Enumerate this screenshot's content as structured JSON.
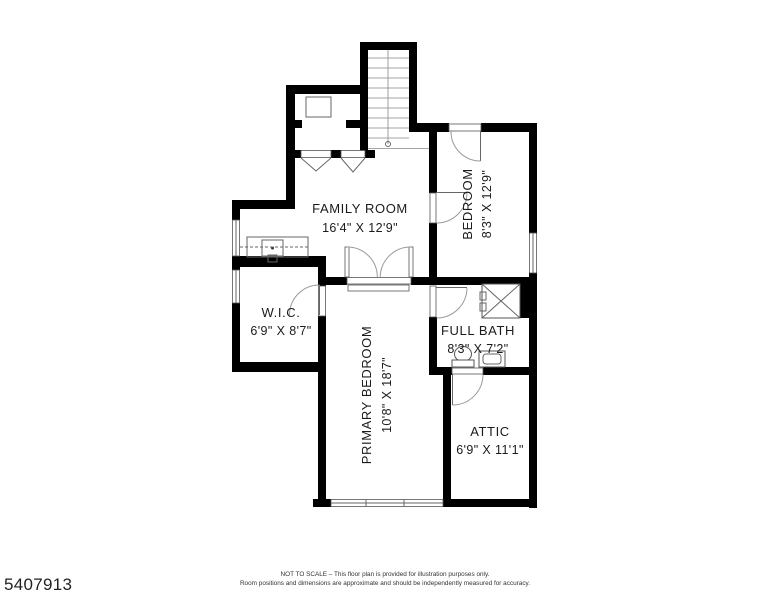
{
  "listing_id": "5407913",
  "rooms": {
    "family": {
      "name": "FAMILY ROOM",
      "dims": "16'4\" X 12'9\""
    },
    "bedroom": {
      "name": "BEDROOM",
      "dims": "8'3\" X 12'9\""
    },
    "wic": {
      "name": "W.I.C.",
      "dims": "6'9\" X 8'7\""
    },
    "bath": {
      "name": "FULL BATH",
      "dims": "8'3\" X 7'2\""
    },
    "primary": {
      "name": "PRIMARY BEDROOM",
      "dims": "10'8\" X 18'7\""
    },
    "attic": {
      "name": "ATTIC",
      "dims": "6'9\" X 11'1\""
    }
  },
  "footer": {
    "line1": "NOT TO SCALE – This floor plan is provided for illustration purposes only.",
    "line2": "Room positions and dimensions are approximate and should be independently measured for accuracy."
  }
}
